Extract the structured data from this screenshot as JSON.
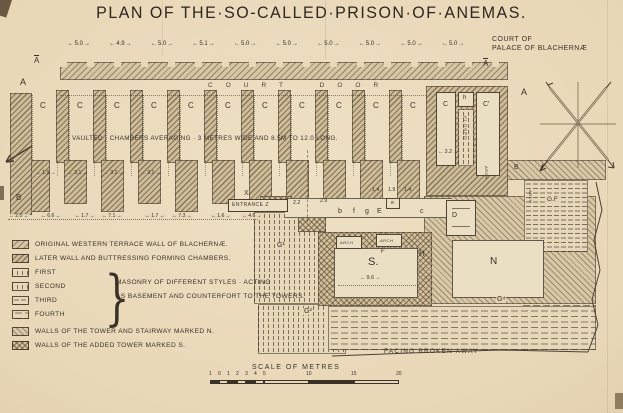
{
  "title": "PLAN OF THE·SO-CALLED·PRISON·OF·ANEMAS.",
  "court": {
    "line1": "COURT OF",
    "line2": "PALACE OF BLACHERNÆ"
  },
  "plan": {
    "top_dimensions": [
      "5.0",
      "4.9",
      "5.0",
      "5.1",
      "5.0",
      "5.0",
      "5.0",
      "5.0",
      "5.0",
      "5.0"
    ],
    "section_marker": "A",
    "court_door": "COURT DOOR",
    "chambers_note": "VAULTED · CHAMBERS AVERAGING · 3 METRES WIDE AND 8.5M TO 12.0 LONG.",
    "chamber_label": "C",
    "chamber_count": 11,
    "pier_dimensions": [
      "1.9",
      "3.1",
      "3.1",
      "3.1"
    ],
    "bottom_dimensions": [
      "2.0",
      "6.6",
      "1.7",
      "7.1",
      "1.7",
      "7.3",
      "1.6",
      "4.6"
    ],
    "west_wall_label": "B",
    "entrance": {
      "label": "ENTRANCE Z",
      "x_mark": "X",
      "dims": [
        "2.2",
        "2.9"
      ],
      "cell_letters": [
        "b",
        "f",
        "g",
        "E",
        "c"
      ],
      "box_letter": "e",
      "upper_dims": [
        "1.4",
        "1.9",
        "1.4"
      ]
    },
    "towers": {
      "c": "C",
      "h": "h",
      "c_prime": "C′",
      "closed": "CLOSED",
      "dim_width": "3.2",
      "arch": "ARCH",
      "d": "D",
      "n": "N",
      "s": "S.",
      "s_dim": "9.6",
      "f": "F",
      "h_mark": "H",
      "b_right": "B",
      "gf": "G.F",
      "g1": "G¹",
      "g2": "G²",
      "g4": "G⁴"
    },
    "facing_note": "FACING BROKEN AWAY"
  },
  "legend": {
    "rows": [
      {
        "swatch": "hatchA",
        "text": "ORIGINAL WESTERN TERRACE WALL OF BLACHERNÆ."
      },
      {
        "swatch": "hatchB",
        "text": "LATER WALL AND BUTTRESSING FORMING CHAMBERS."
      },
      {
        "swatch": "vdash",
        "text": "FIRST"
      },
      {
        "swatch": "vdash",
        "text": "SECOND"
      },
      {
        "swatch": "hdash",
        "text": "THIRD"
      },
      {
        "swatch": "hdash2",
        "text": "FOURTH"
      },
      {
        "swatch": "hatchN",
        "text": "WALLS OF THE TOWER AND STAIRWAY MARKED N."
      },
      {
        "swatch": "check",
        "text": "WALLS OF THE ADDED TOWER MARKED S."
      }
    ],
    "brace_note_line1": "MASONRY OF DIFFERENT STYLES · ACTING",
    "brace_note_line2": "AS BASEMENT AND COUNTERFORT TO THE TOWERS."
  },
  "scale": {
    "title": "SCALE OF METRES",
    "tick_labels_small": [
      "1",
      "0",
      "1",
      "2",
      "3",
      "4",
      "5"
    ],
    "tick_labels_major": [
      "10",
      "15",
      "20"
    ]
  },
  "colors": {
    "paper": "#e8d8b8",
    "ink": "#3a3128",
    "wall_fill": "#d7c6a3",
    "hatch_line": "#5c4e3a"
  }
}
